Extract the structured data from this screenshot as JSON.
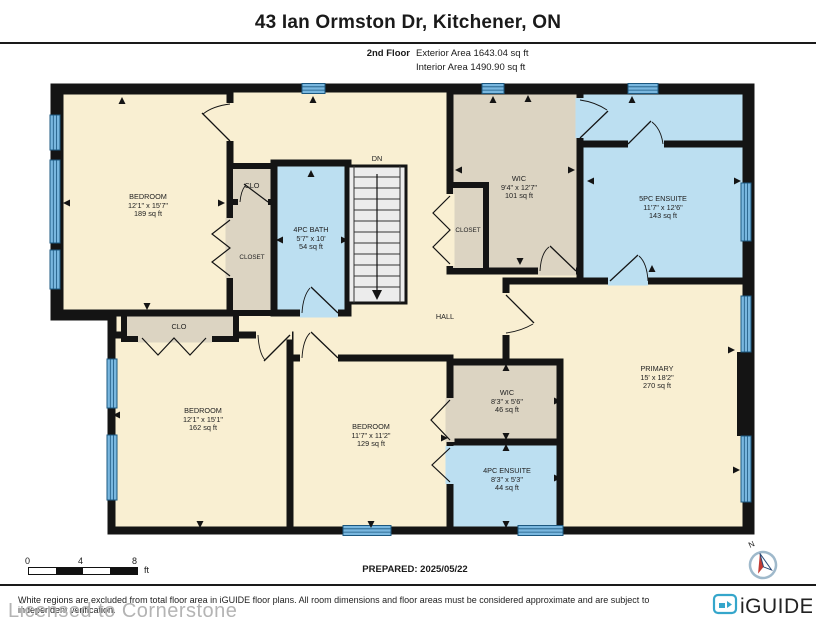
{
  "header": {
    "title": "43 Ian Ormston Dr, Kitchener, ON",
    "floor_label": "2nd Floor",
    "exterior_area": "Exterior Area 1643.04 sq ft",
    "interior_area": "Interior Area 1490.90 sq ft"
  },
  "rooms": [
    {
      "id": "bedroom-top-left",
      "name": "BEDROOM",
      "dims": "12'1\" x 15'7\"",
      "area": "189 sq ft"
    },
    {
      "id": "clo-top",
      "name": "CLO"
    },
    {
      "id": "closet-top-left",
      "name": "CLOSET"
    },
    {
      "id": "bath-4pc",
      "name": "4PC BATH",
      "dims": "5'7\" x 10'",
      "area": "54 sq ft"
    },
    {
      "id": "stairs",
      "name": "DN"
    },
    {
      "id": "hall",
      "name": "HALL"
    },
    {
      "id": "wic-top",
      "name": "WIC",
      "dims": "9'4\" x 12'7\"",
      "area": "101 sq ft"
    },
    {
      "id": "closet-mid",
      "name": "CLOSET"
    },
    {
      "id": "ensuite-5pc",
      "name": "5PC ENSUITE",
      "dims": "11'7\" x 12'6\"",
      "area": "143 sq ft"
    },
    {
      "id": "primary",
      "name": "PRIMARY",
      "dims": "15' x 18'2\"",
      "area": "270 sq ft"
    },
    {
      "id": "wic-bottom",
      "name": "WIC",
      "dims": "8'3\" x 5'6\"",
      "area": "46 sq ft"
    },
    {
      "id": "ensuite-4pc",
      "name": "4PC ENSUITE",
      "dims": "8'3\" x 5'3\"",
      "area": "44 sq ft"
    },
    {
      "id": "bedroom-bottom-left",
      "name": "BEDROOM",
      "dims": "12'1\" x 15'1\"",
      "area": "162 sq ft"
    },
    {
      "id": "clo-bottom",
      "name": "CLO"
    },
    {
      "id": "bedroom-bottom-mid",
      "name": "BEDROOM",
      "dims": "11'7\" x 11'2\"",
      "area": "129 sq ft"
    }
  ],
  "footer": {
    "scale": {
      "start": "0",
      "mid": "4",
      "end": "8",
      "unit": "ft"
    },
    "prepared": "PREPARED: 2025/05/22",
    "disclaimer": "White regions are excluded from total floor area in iGUIDE floor plans. All room dimensions and floor areas must be considered approximate and are subject to independent verification.",
    "watermark": "Licensed to Cornerstone",
    "brand": "iGUIDE",
    "compass_label": "N"
  },
  "colors": {
    "room_cream": "#F9EFD2",
    "room_closet_beige": "#DCD4C2",
    "room_wet_blue": "#BCDFF1",
    "stairs_gray": "#ECECEC",
    "wall_black": "#141414",
    "window_blue": "#79B7DF",
    "window_line": "#1C5880",
    "brand_teal": "#35A6CB",
    "compass_red": "#C23B33",
    "compass_navy": "#2A4A77"
  }
}
